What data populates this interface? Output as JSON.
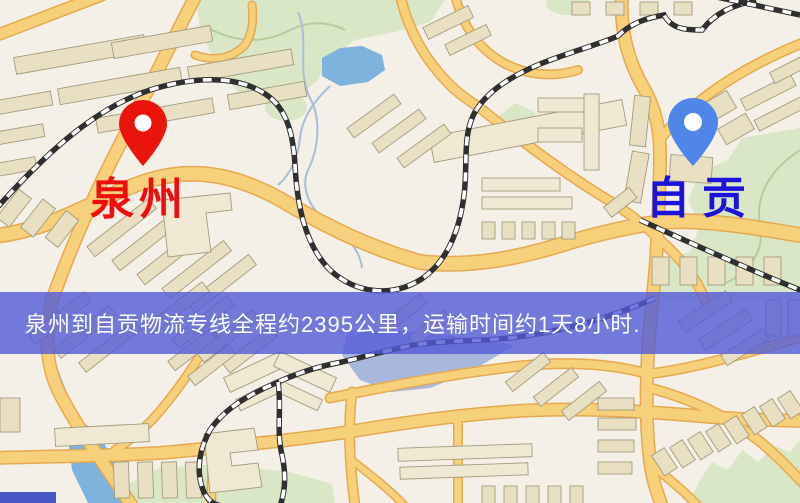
{
  "map": {
    "markers": {
      "origin": {
        "label": "泉州",
        "pin": "red-map-pin",
        "pin_color": "#e9150d",
        "label_color": "#f20d0d"
      },
      "destination": {
        "label": "自贡",
        "pin": "blue-map-pin",
        "pin_color": "#4f86e8",
        "label_color": "#1b13da"
      }
    },
    "banner": {
      "text": "泉州到自贡物流专线全程约2395公里，运输时间约1天8小时.",
      "bg_color": "rgba(82,90,216,0.8)",
      "text_color": "#fdfdfd"
    },
    "route": {
      "origin": "泉州",
      "destination": "自贡",
      "distance_text": "约2395公里",
      "duration_text": "约1天8小时"
    }
  },
  "palette": {
    "label_origin": "#f20d0d",
    "label_dest": "#1b13da",
    "banner_bg": "rgba(82,90,216,0.8)",
    "banner_text": "#fdfdfd",
    "pin_origin": "#e9150d",
    "pin_dest": "#4f86e8",
    "map_bg": "#f4f0e7",
    "road_fill": "#f6d07b",
    "road_edge": "#e5a950",
    "park_green": "#d9e7c6",
    "water_blue": "#7fb2dd"
  }
}
